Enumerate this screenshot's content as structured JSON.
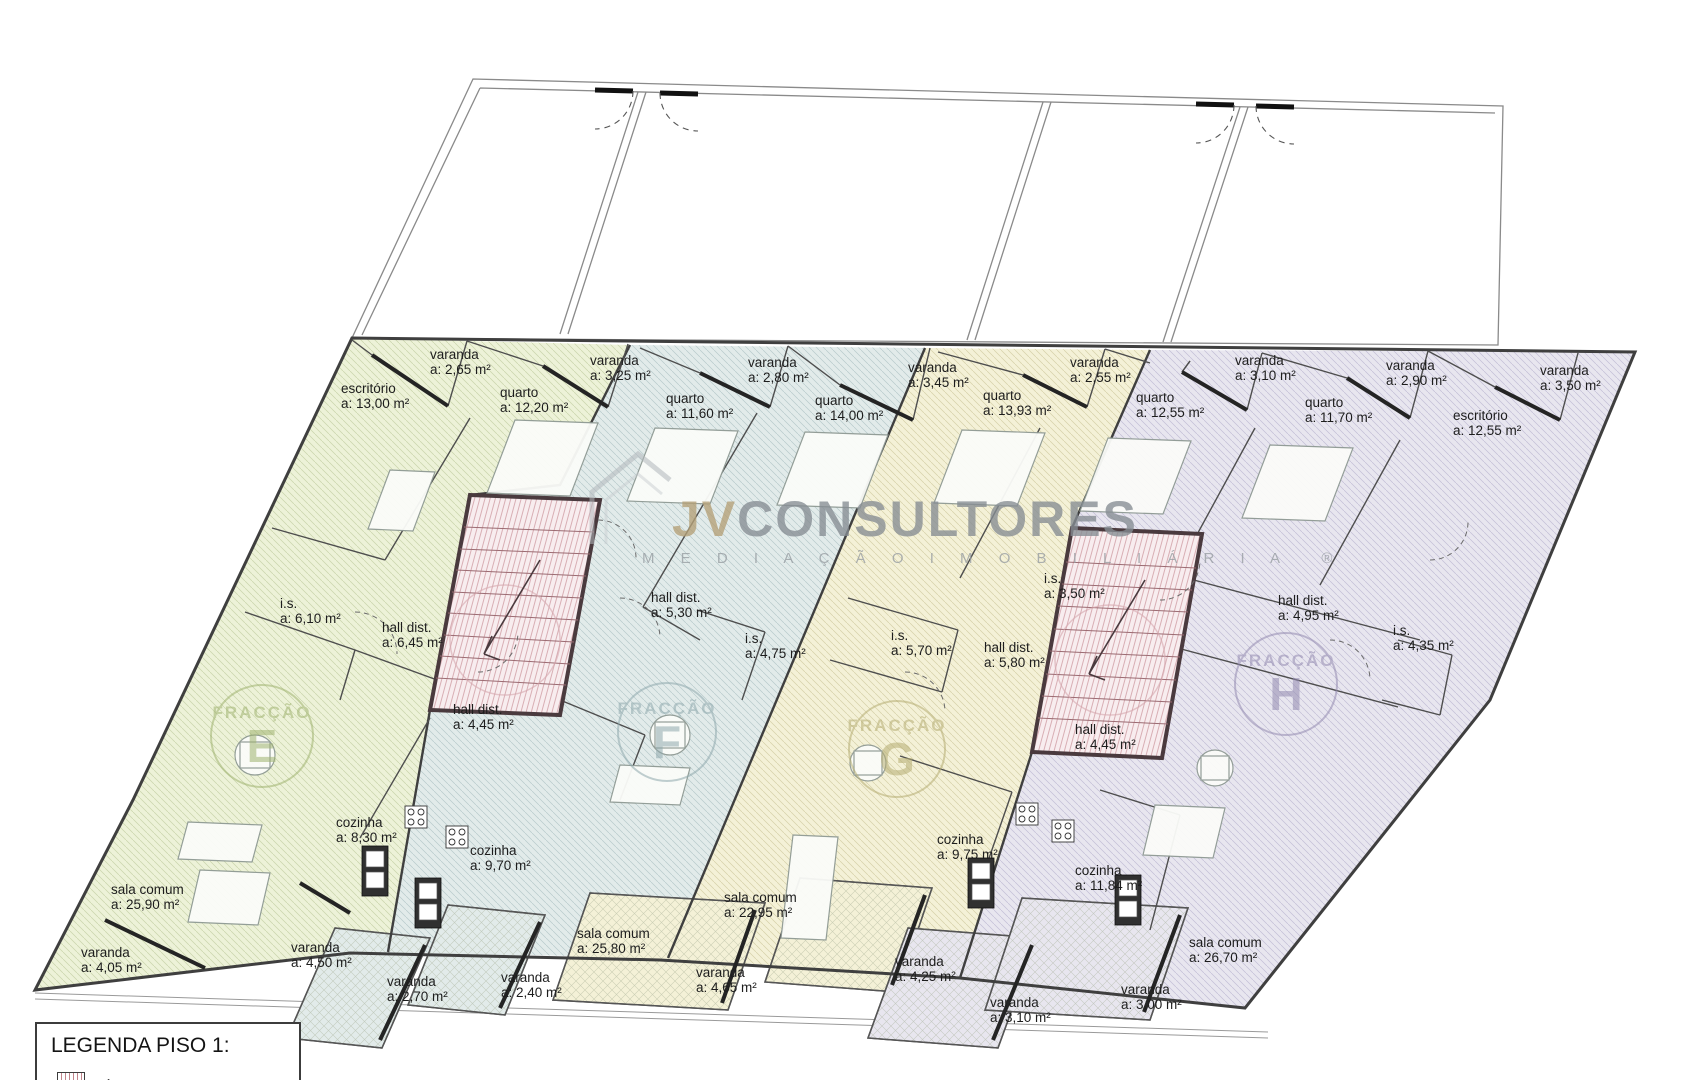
{
  "watermark": {
    "brand_prefix": "JV",
    "brand_rest": "CONSULTORES",
    "subtitle": "M E D I A Ç Ã O   I M O B I L I Á R I A",
    "registered_mark": "®"
  },
  "legend": {
    "title": "LEGENDA PISO 1:",
    "items": [
      {
        "swatch": "areas-comuns-hatch",
        "label": "ÁREAS COMUNS",
        "area": "a: 29,05 m²"
      }
    ]
  },
  "fractions": [
    {
      "name": "FRACÇÃO",
      "letter": "E",
      "x": 262,
      "y": 737,
      "r": 50,
      "color": "#9fb36f"
    },
    {
      "name": "FRACÇÃO",
      "letter": "F",
      "x": 667,
      "y": 733,
      "r": 48,
      "color": "#8fa9ad"
    },
    {
      "name": "FRACÇÃO",
      "letter": "G",
      "x": 897,
      "y": 750,
      "r": 47,
      "color": "#b5ad72"
    },
    {
      "name": "FRACÇÃO",
      "letter": "H",
      "x": 1286,
      "y": 685,
      "r": 50,
      "color": "#948bb1"
    }
  ],
  "rooms": [
    {
      "label": "varanda",
      "area": "a:  2,65 m²",
      "x": 430,
      "y": 347
    },
    {
      "label": "varanda",
      "area": "a:  3,25 m²",
      "x": 590,
      "y": 353
    },
    {
      "label": "varanda",
      "area": "a:  2,80 m²",
      "x": 748,
      "y": 355
    },
    {
      "label": "varanda",
      "area": "a:  3,45 m²",
      "x": 908,
      "y": 360
    },
    {
      "label": "varanda",
      "area": "a:  2,55 m²",
      "x": 1070,
      "y": 355
    },
    {
      "label": "varanda",
      "area": "a:  3,10 m²",
      "x": 1235,
      "y": 353
    },
    {
      "label": "varanda",
      "area": "a:  2,90 m²",
      "x": 1386,
      "y": 358
    },
    {
      "label": "varanda",
      "area": "a:  3,50 m²",
      "x": 1540,
      "y": 363
    },
    {
      "label": "escritório",
      "area": "a:  13,00 m²",
      "x": 341,
      "y": 381
    },
    {
      "label": "quarto",
      "area": "a:  12,20 m²",
      "x": 500,
      "y": 385
    },
    {
      "label": "quarto",
      "area": "a:  11,60 m²",
      "x": 666,
      "y": 391
    },
    {
      "label": "quarto",
      "area": "a:  14,00 m²",
      "x": 815,
      "y": 393
    },
    {
      "label": "quarto",
      "area": "a:  13,93 m²",
      "x": 983,
      "y": 388
    },
    {
      "label": "quarto",
      "area": "a:  12,55 m²",
      "x": 1136,
      "y": 390
    },
    {
      "label": "quarto",
      "area": "a:  11,70 m²",
      "x": 1305,
      "y": 395
    },
    {
      "label": "escritório",
      "area": "a:  12,55 m²",
      "x": 1453,
      "y": 408
    },
    {
      "label": "i.s.",
      "area": "a:  6,10 m²",
      "x": 280,
      "y": 596
    },
    {
      "label": "hall dist.",
      "area": "a:  6,45 m²",
      "x": 382,
      "y": 620
    },
    {
      "label": "hall dist.",
      "area": "a:  4,45 m²",
      "x": 453,
      "y": 702
    },
    {
      "label": "hall dist.",
      "area": "a:  5,30 m²",
      "x": 651,
      "y": 590
    },
    {
      "label": "i.s.",
      "area": "a:  4,75 m²",
      "x": 745,
      "y": 631
    },
    {
      "label": "i.s.",
      "area": "a:  5,70 m²",
      "x": 891,
      "y": 628
    },
    {
      "label": "hall dist.",
      "area": "a:  5,80 m²",
      "x": 984,
      "y": 640
    },
    {
      "label": "i.s.",
      "area": "a:  3,50 m²",
      "x": 1044,
      "y": 571
    },
    {
      "label": "hall dist.",
      "area": "a:  4,45 m²",
      "x": 1075,
      "y": 722
    },
    {
      "label": "hall dist.",
      "area": "a:  4,95 m²",
      "x": 1278,
      "y": 593
    },
    {
      "label": "i.s.",
      "area": "a:  4,35 m²",
      "x": 1393,
      "y": 623
    },
    {
      "label": "cozinha",
      "area": "a:  8,30 m²",
      "x": 336,
      "y": 815
    },
    {
      "label": "sala comum",
      "area": "a:  25,90 m²",
      "x": 111,
      "y": 882
    },
    {
      "label": "varanda",
      "area": "a:  4,05 m²",
      "x": 81,
      "y": 945
    },
    {
      "label": "varanda",
      "area": "a:  4,50 m²",
      "x": 291,
      "y": 940
    },
    {
      "label": "varanda",
      "area": "a:  2,70 m²",
      "x": 387,
      "y": 974
    },
    {
      "label": "cozinha",
      "area": "a:  9,70 m²",
      "x": 470,
      "y": 843
    },
    {
      "label": "sala comum",
      "area": "a:  25,80 m²",
      "x": 577,
      "y": 926
    },
    {
      "label": "varanda",
      "area": "a:  2,40 m²",
      "x": 501,
      "y": 970
    },
    {
      "label": "sala comum",
      "area": "a:  22,95 m²",
      "x": 724,
      "y": 890
    },
    {
      "label": "varanda",
      "area": "a:  4,65 m²",
      "x": 696,
      "y": 965
    },
    {
      "label": "cozinha",
      "area": "a:  9,75 m²",
      "x": 937,
      "y": 832
    },
    {
      "label": "cozinha",
      "area": "a:  11,84 m²",
      "x": 1075,
      "y": 863
    },
    {
      "label": "varanda",
      "area": "a:  4,25 m²",
      "x": 895,
      "y": 954
    },
    {
      "label": "varanda",
      "area": "a:  3,10 m²",
      "x": 990,
      "y": 995
    },
    {
      "label": "varanda",
      "area": "a:  3,00 m²",
      "x": 1121,
      "y": 982
    },
    {
      "label": "sala comum",
      "area": "a:  26,70 m²",
      "x": 1189,
      "y": 935
    }
  ],
  "colors": {
    "fraction_e_fill": "#edf2d8",
    "fraction_f_fill": "#e2ebea",
    "fraction_g_fill": "#f4f1d7",
    "fraction_h_fill": "#e8e6ef",
    "common_area_fill": "#f8edef",
    "common_area_line": "#c2848c"
  }
}
